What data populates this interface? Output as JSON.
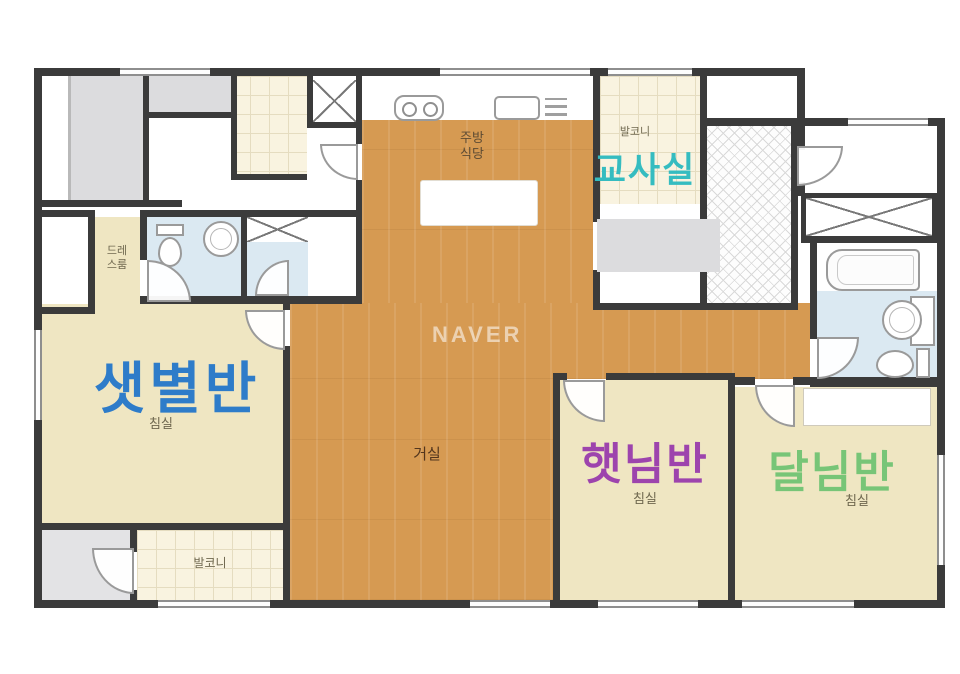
{
  "watermark": {
    "text": "NAVER"
  },
  "annotations": {
    "saetbyeol": "샛별반",
    "gyosasil": "교사실",
    "haetnim": "햇님반",
    "dalnim": "달님반"
  },
  "labels": {
    "kitchen_dining_line1": "주방",
    "kitchen_dining_line2": "식당",
    "living_room": "거실",
    "bedroom": "침실",
    "balcony": "발코니",
    "dress_room_line1": "드레",
    "dress_room_line2": "스룸"
  },
  "colors": {
    "wall": "#3b3b3b",
    "wood": "#d69a52",
    "tan": "#efe6c2",
    "bath": "#dbe9f2",
    "gray": "#dcdcde",
    "tile": "#f9f3e0",
    "saetbyeol": "#2e7cc9",
    "gyosasil": "#35bcc0",
    "haetnim": "#9d44ad",
    "dalnim": "#77c577"
  },
  "icons": {
    "stove": "stove-icon",
    "kitchen_sink": "kitchen-sink-icon",
    "drain_rack": "drain-rack-icon",
    "toilet": "toilet-icon",
    "washbasin": "washbasin-icon",
    "bathtub": "bathtub-icon",
    "wardrobe": "wardrobe-x-icon",
    "duct": "duct-x-icon",
    "door": "door-swing-icon"
  }
}
